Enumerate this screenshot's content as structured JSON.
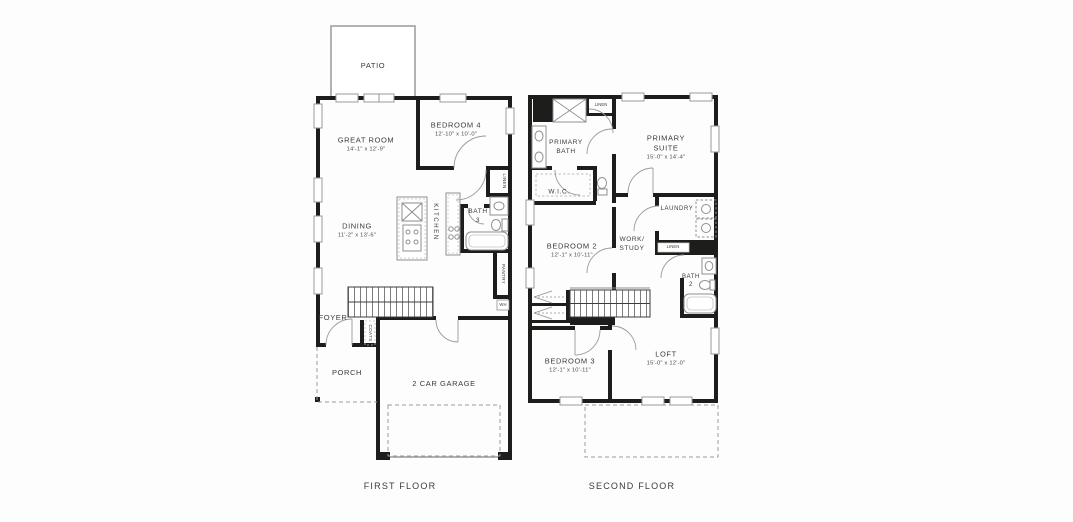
{
  "colors": {
    "wall": "#1d1d1b",
    "line_gray": "#9a9a9a",
    "text": "#3b3b3b"
  },
  "first_floor": {
    "floor_label": "FIRST FLOOR",
    "patio": {
      "name": "PATIO"
    },
    "great_room": {
      "name": "GREAT ROOM",
      "dims": "14'-1\" x 12'-9\""
    },
    "bedroom_4": {
      "name": "BEDROOM 4",
      "dims": "12'-10\" x 10'-0\""
    },
    "dining": {
      "name": "DINING",
      "dims": "11'-2\" x 13'-6\""
    },
    "kitchen": {
      "name": "KITCHEN"
    },
    "bath_3": {
      "name": "BATH",
      "number": "3"
    },
    "linen": {
      "name": "LINEN"
    },
    "pantry": {
      "name": "PANTRY"
    },
    "water_heater": {
      "name": "WH"
    },
    "foyer": {
      "name": "FOYER"
    },
    "coats": {
      "name": "COATS"
    },
    "porch": {
      "name": "PORCH"
    },
    "garage": {
      "name": "2 CAR GARAGE"
    }
  },
  "second_floor": {
    "floor_label": "SECOND FLOOR",
    "primary_bath": {
      "name": "PRIMARY",
      "name2": "BATH"
    },
    "linen_upper": {
      "name": "LINEN"
    },
    "primary_suite": {
      "name": "PRIMARY",
      "name2": "SUITE",
      "dims": "15'-0\" x 14'-4\""
    },
    "wic": {
      "name": "W.I.C."
    },
    "laundry": {
      "name": "LAUNDRY"
    },
    "linen_hall": {
      "name": "LINEN"
    },
    "bedroom_2": {
      "name": "BEDROOM 2",
      "dims": "12'-1\" x 10'-11\""
    },
    "work_study": {
      "name": "WORK/",
      "name2": "STUDY"
    },
    "bath_2": {
      "name": "BATH",
      "number": "2"
    },
    "bedroom_3": {
      "name": "BEDROOM 3",
      "dims": "12'-1\" x 10'-11\""
    },
    "loft": {
      "name": "LOFT",
      "dims": "15'-0\" x 12'-0\""
    }
  }
}
